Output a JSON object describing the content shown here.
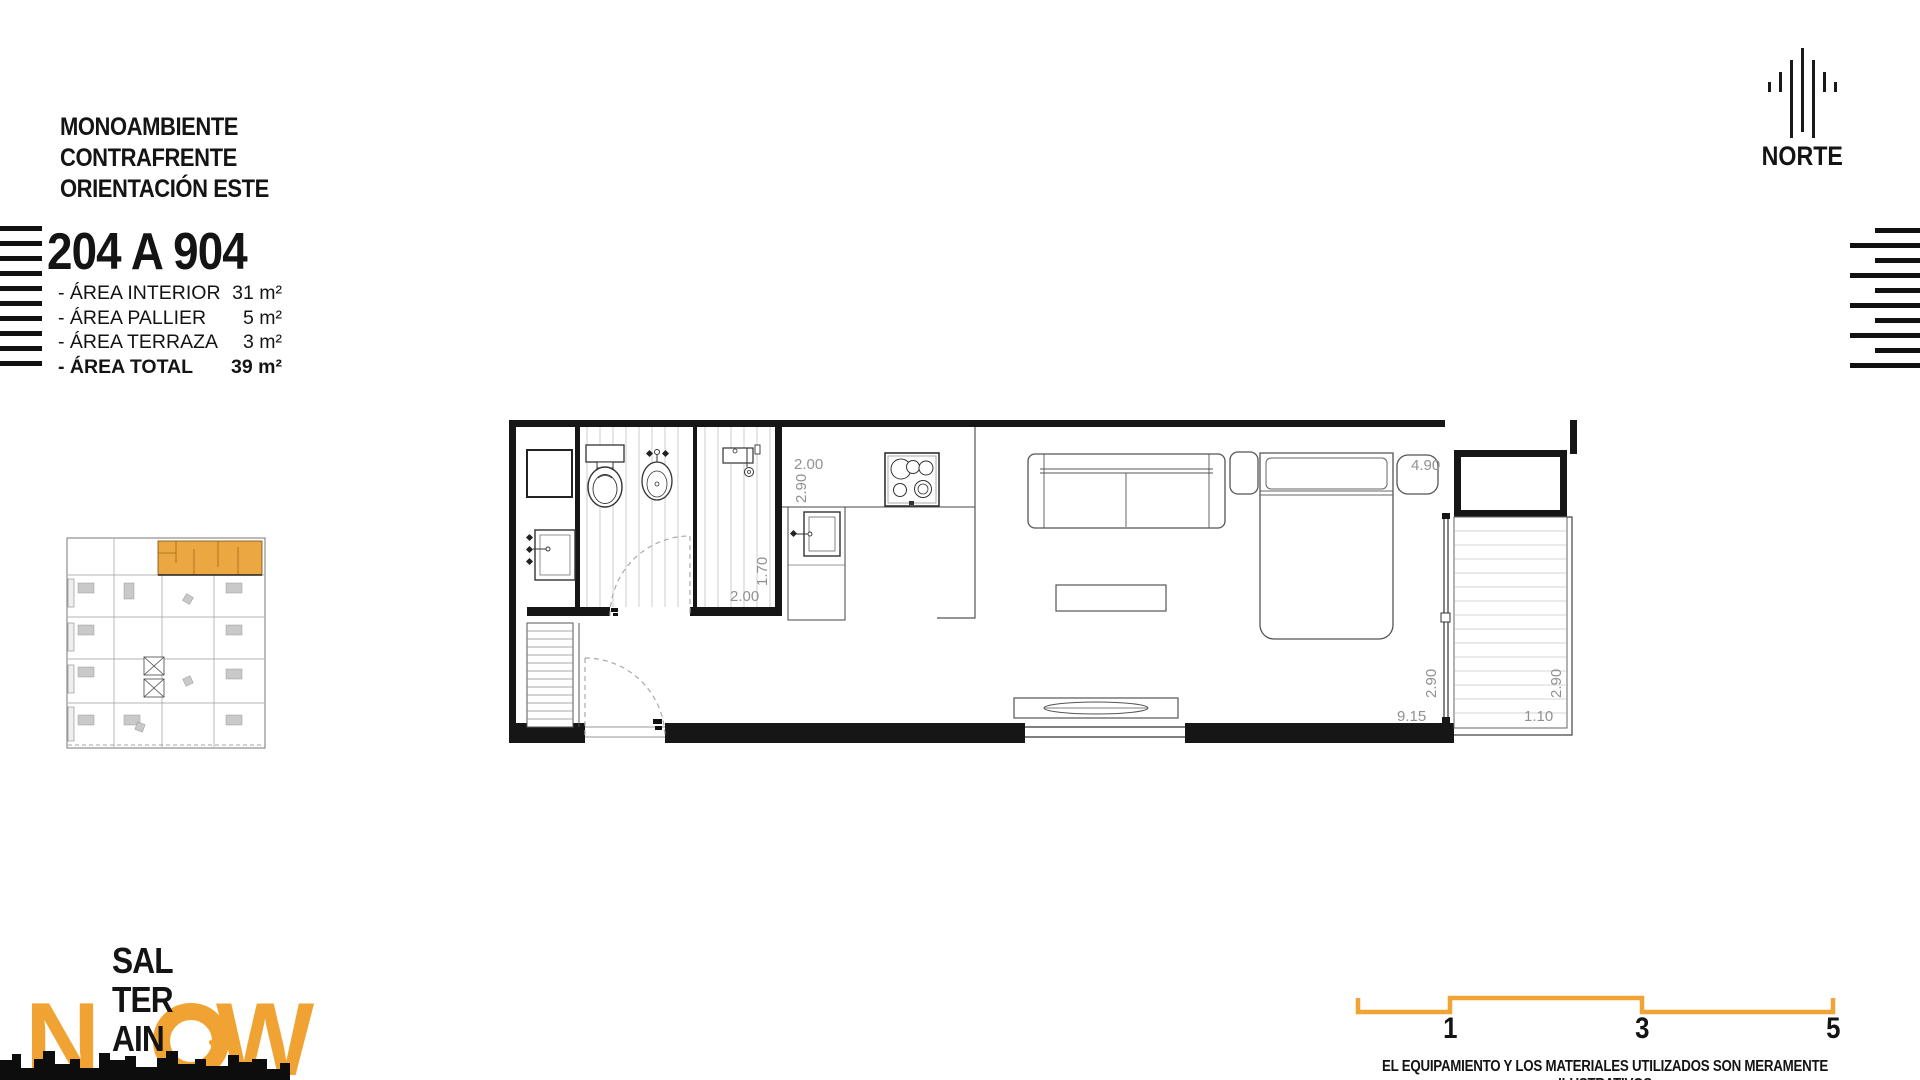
{
  "unit_info": {
    "type_lines": [
      "MONOAMBIENTE",
      "CONTRAFRENTE",
      "ORIENTACIÓN ESTE"
    ],
    "unit_range": "204 A 904",
    "areas": [
      {
        "label": "- ÁREA INTERIOR",
        "value": "31 m²"
      },
      {
        "label": "- ÁREA PALLIER",
        "value": "5 m²"
      },
      {
        "label": "- ÁREA TERRAZA",
        "value": "3 m²"
      },
      {
        "label": "- ÁREA TOTAL",
        "value": "39 m²"
      }
    ]
  },
  "compass": {
    "label": "NORTE"
  },
  "plan": {
    "dims": [
      {
        "id": "kitchen-width",
        "text": "2.00"
      },
      {
        "id": "kitchen-depth",
        "text": "2.90"
      },
      {
        "id": "bath-depth",
        "text": "1.70"
      },
      {
        "id": "bath-width",
        "text": "2.00"
      },
      {
        "id": "bedroom-width",
        "text": "4.90"
      },
      {
        "id": "room-depth",
        "text": "2.90"
      },
      {
        "id": "room-length",
        "text": "9.15"
      },
      {
        "id": "terrace-depth",
        "text": "2.90"
      },
      {
        "id": "terrace-width",
        "text": "1.10"
      }
    ]
  },
  "logo": {
    "stacked": [
      "SAL",
      "TER",
      "AIN"
    ],
    "now_letters": [
      "N",
      "O",
      "W"
    ],
    "heart": "♥"
  },
  "scale_bar": {
    "ticks": [
      "1",
      "3",
      "5"
    ]
  },
  "disclaimer": "EL EQUIPAMIENTO Y LOS MATERIALES UTILIZADOS SON MERAMENTE ILUSTRATIVOS",
  "colors": {
    "accent_orange": "#F0A435",
    "keyplan_orange": "#EBA742",
    "wall_black": "#161616",
    "dim_gray": "#919191"
  }
}
